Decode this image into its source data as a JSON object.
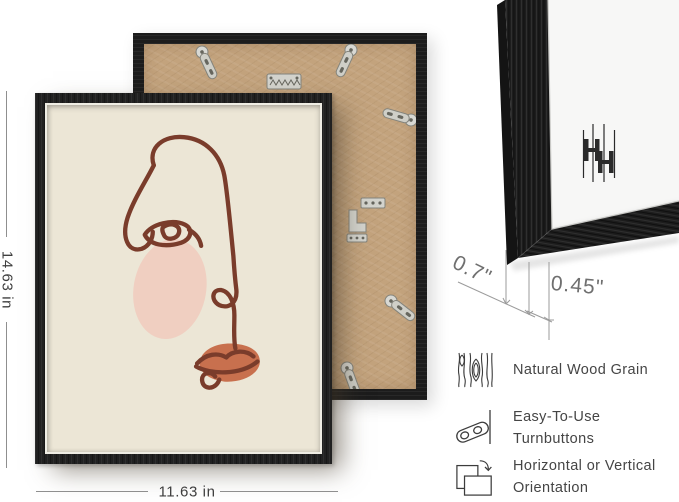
{
  "dimensions": {
    "height": "14.63 in",
    "width": "11.63 in",
    "depth": "0.7\"",
    "face_width": "0.45\""
  },
  "features": [
    {
      "icon": "wood-grain-icon",
      "label": "Natural Wood Grain"
    },
    {
      "icon": "turnbutton-icon",
      "label": "Easy-To-Use Turnbuttons"
    },
    {
      "icon": "orientation-icon",
      "label": "Horizontal or Vertical Orientation"
    }
  ],
  "colors": {
    "frame_black": "#212121",
    "backboard_kraft": "#c3a37d",
    "art_background": "#ece6d6",
    "line_art": "#7a3c2b",
    "cheek_blush": "#f0cfc1",
    "lips_terracotta": "#c8704e",
    "metal_hardware": "#d3d3cd",
    "dimension_text": "#3f3f3f",
    "annotation_gray": "#9b9b9b",
    "mat_white": "#f7f7f6"
  }
}
